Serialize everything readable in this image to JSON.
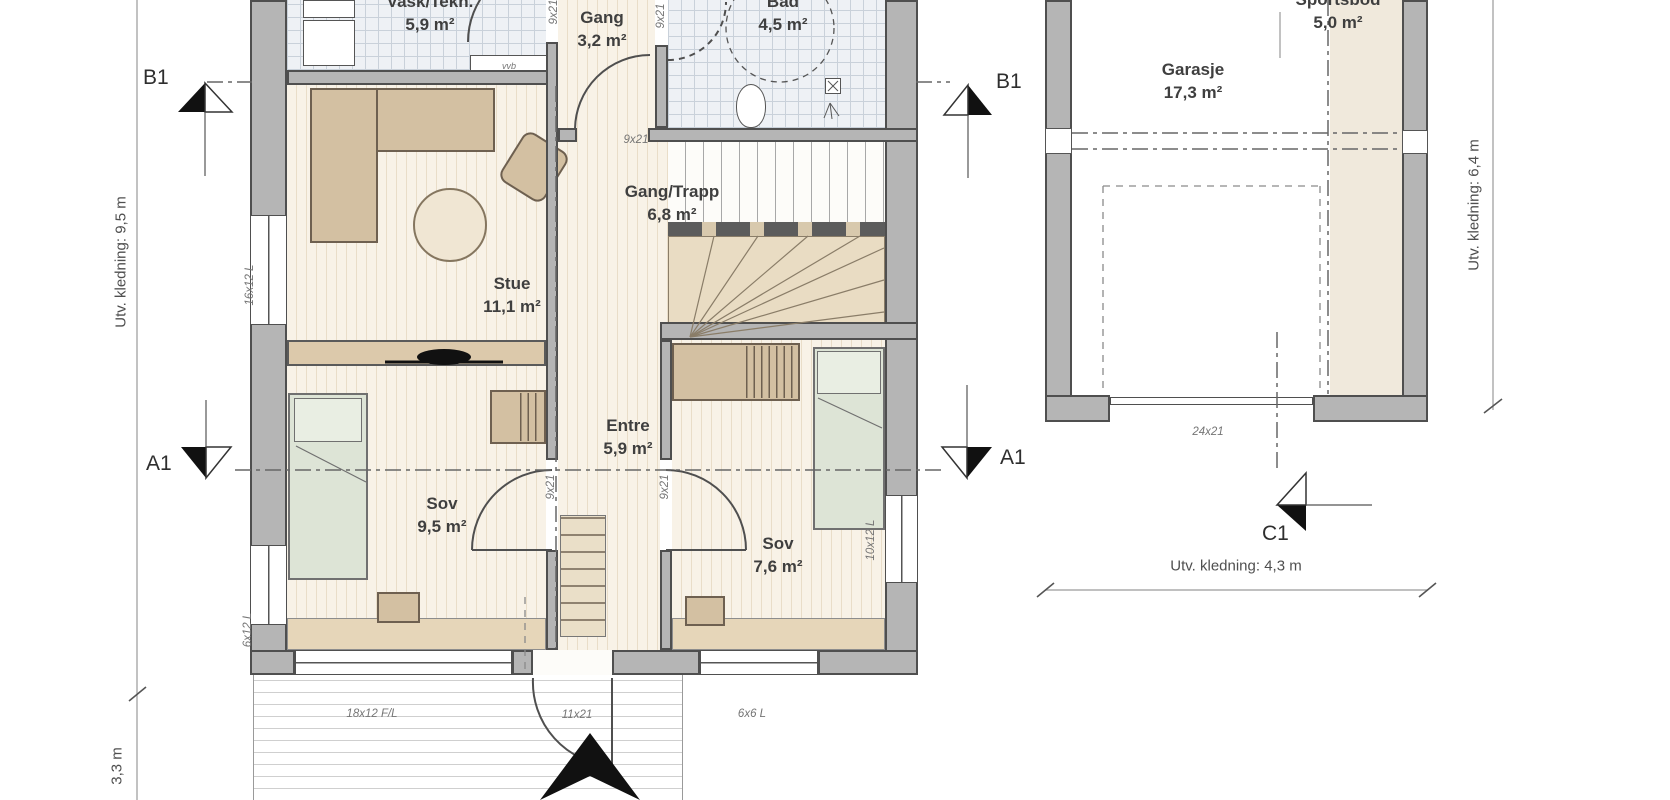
{
  "rooms": {
    "vask": {
      "name": "Vask/Tekn.",
      "area": "5,9 m²"
    },
    "gang": {
      "name": "Gang",
      "area": "3,2 m²"
    },
    "bad": {
      "name": "Bad",
      "area": "4,5 m²"
    },
    "stue": {
      "name": "Stue",
      "area": "11,1 m²"
    },
    "gang_trapp": {
      "name": "Gang/Trapp",
      "area": "6,8 m²"
    },
    "entre": {
      "name": "Entre",
      "area": "5,9 m²"
    },
    "sov1": {
      "name": "Sov",
      "area": "9,5 m²"
    },
    "sov2": {
      "name": "Sov",
      "area": "7,6 m²"
    },
    "garasje": {
      "name": "Garasje",
      "area": "17,3 m²"
    },
    "sportsbod": {
      "name": "Sportsbod",
      "area": "5,0 m²"
    }
  },
  "markers": {
    "b1": "B1",
    "a1": "A1",
    "c1": "C1"
  },
  "dimensions": {
    "left_wall": "Utv. kledning: 9,5 m",
    "deck_depth": "3,3 m",
    "garage_right": "Utv. kledning: 6,4 m",
    "garage_bottom": "Utv. kledning: 4,3 m"
  },
  "openings": {
    "window_left_top": "16x12 L",
    "window_left_bottom": "6x12 L",
    "window_right": "10x12 L",
    "window_bottom_left": "18x12 F/L",
    "entry_door": "11x21",
    "window_bottom_right": "6x6 L",
    "garage_door": "24x21",
    "door_gang": "9x21",
    "door_sov1": "9x21",
    "door_sov2": "9x21",
    "door_top_left": "9x21",
    "door_top_right": "9x21",
    "water_heater": "vvb"
  },
  "colors": {
    "wall_fill": "#b5b5b5",
    "wall_edge": "#4f4f4f",
    "furniture_tan": "#d3c0a2",
    "bed_green": "#dde4d6",
    "tile_floor": "#eef1f5",
    "wood_floor": "#f8f2e7",
    "marker_black": "#111111"
  }
}
